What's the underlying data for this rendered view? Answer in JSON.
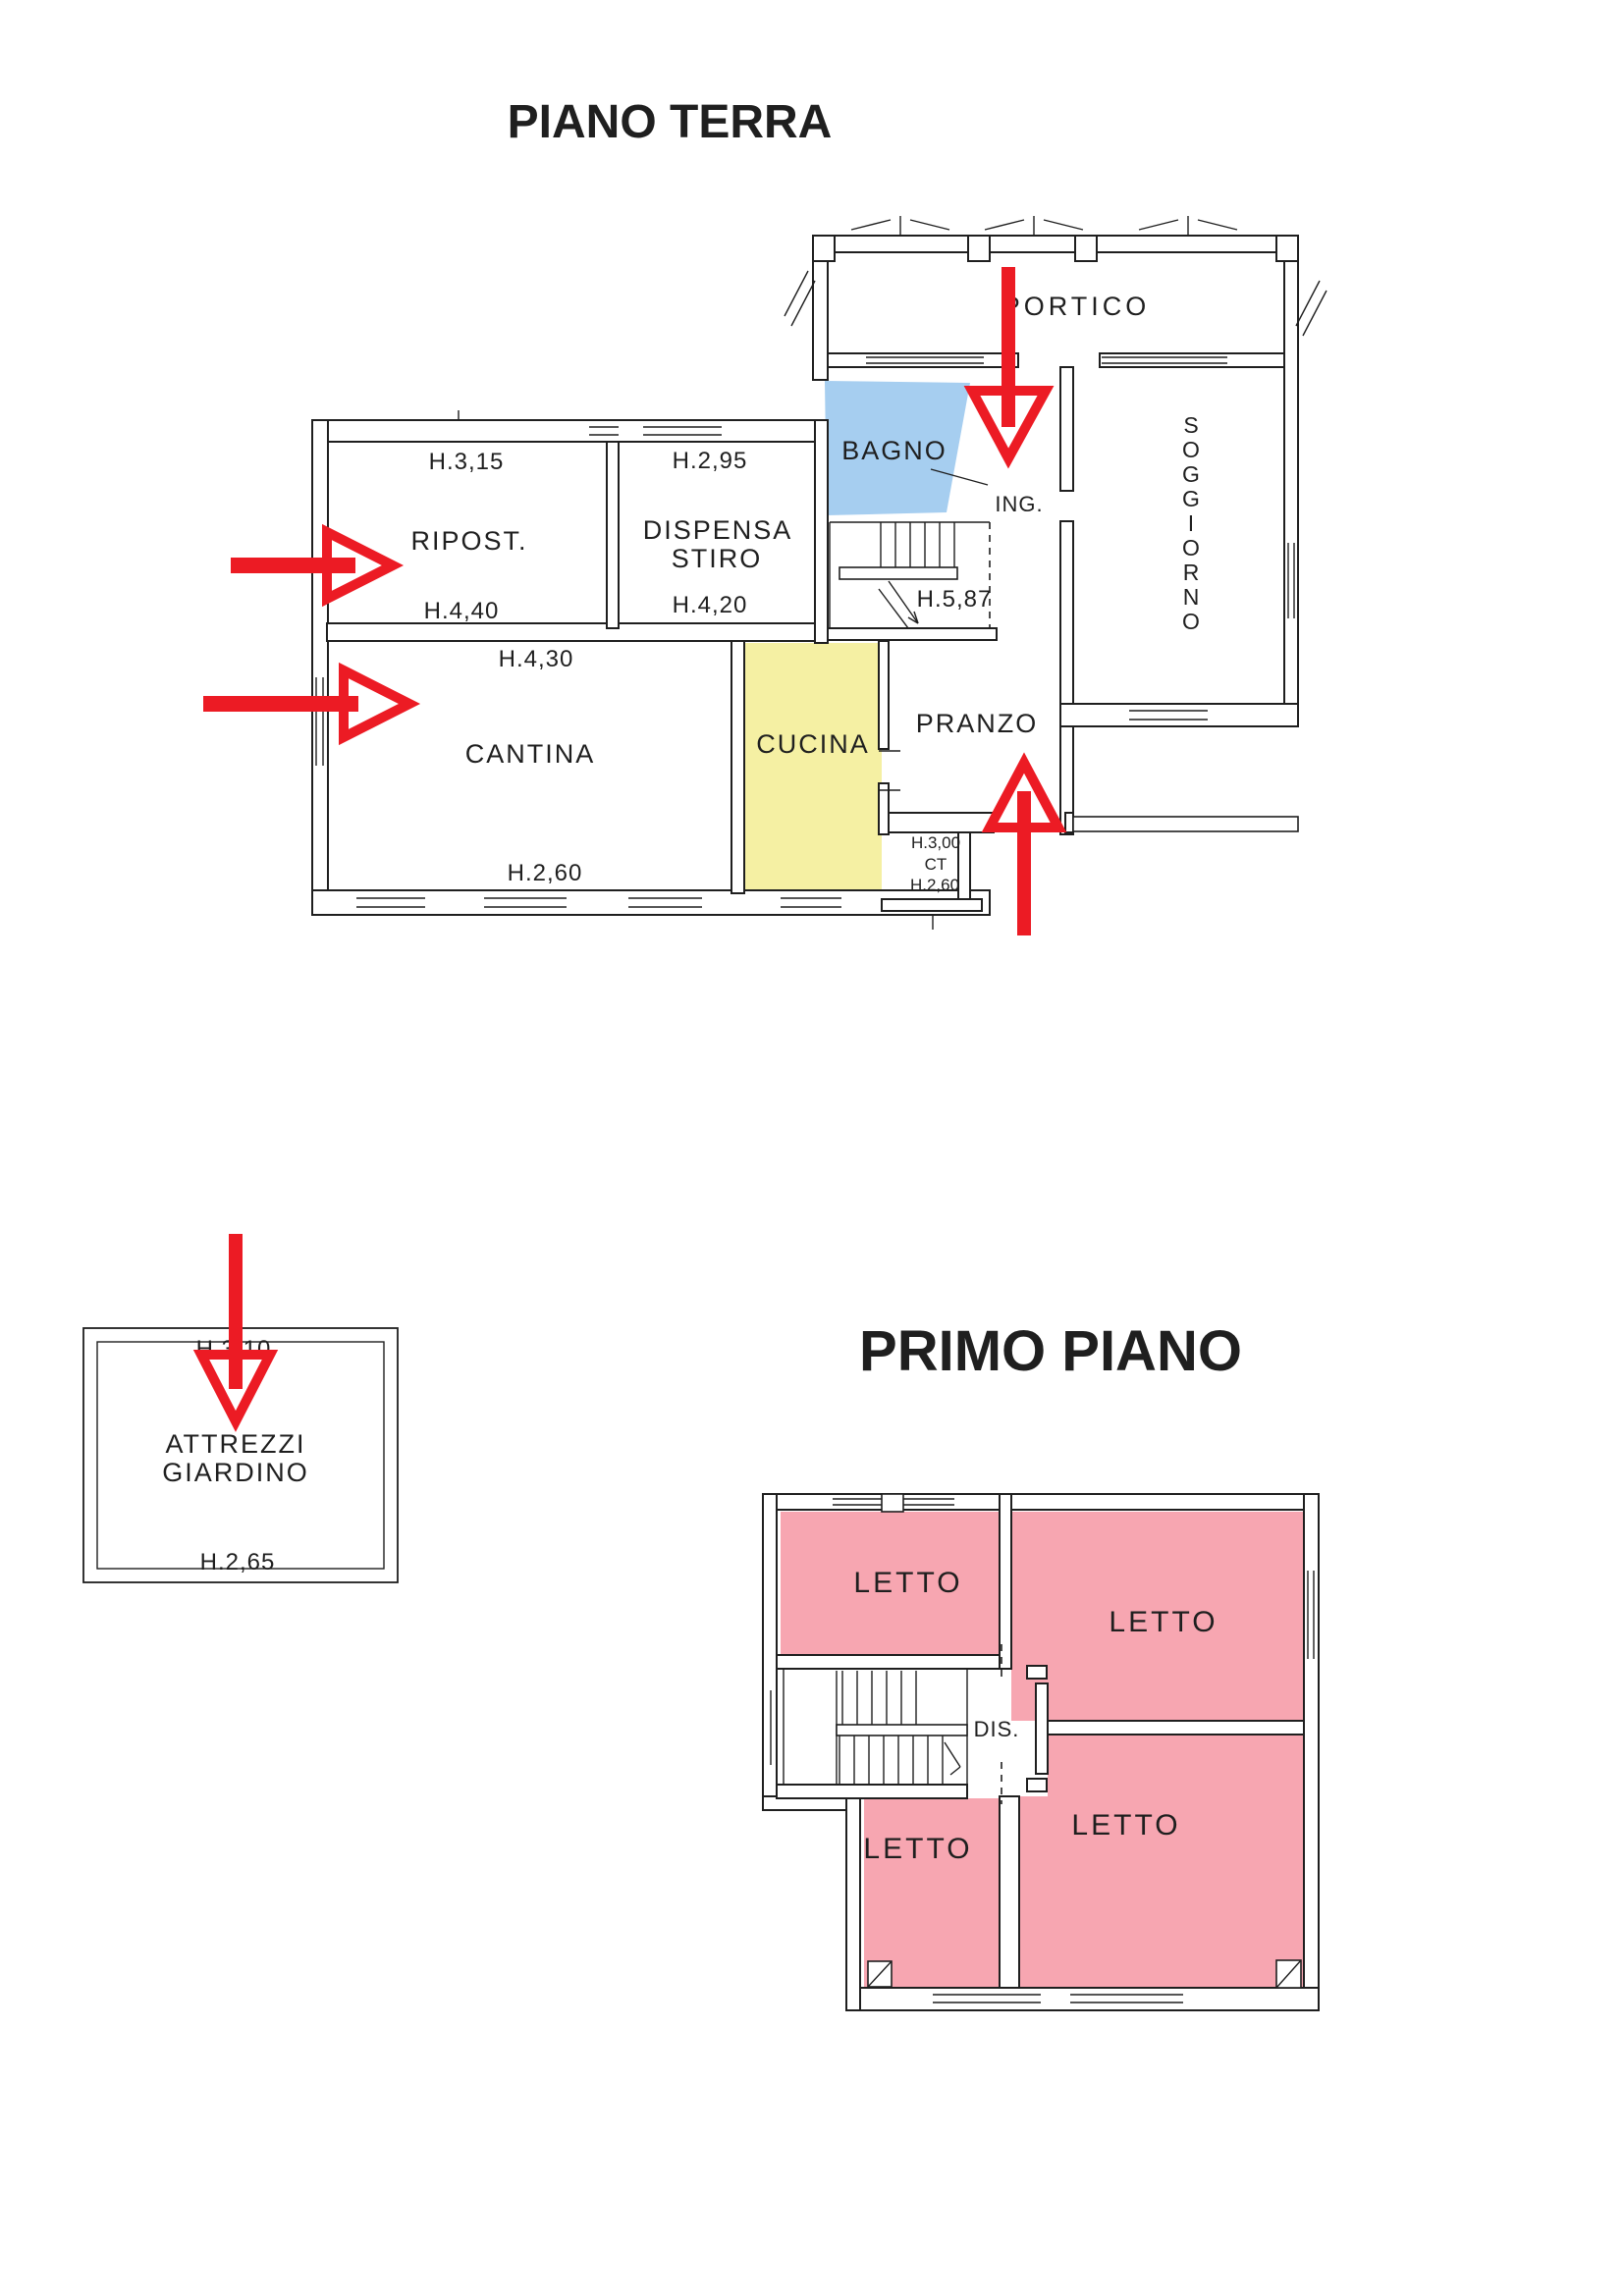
{
  "colors": {
    "arrow": "#EC1B24",
    "title": "#EC1B24",
    "bagno_fill": "#A6CEF0",
    "bagno_text": "#2B6CB8",
    "cucina_fill": "#F5F0A3",
    "cucina_text": "#8F8F45",
    "letto_fill": "#F7A6B1",
    "letto_text": "#7A2B35",
    "line": "#1F1F1F",
    "background": "#FFFFFF"
  },
  "ground": {
    "title": "PIANO TERRA",
    "rooms": {
      "portico": "PORTICO",
      "bagno": "BAGNO",
      "ingresso": "ING.",
      "soggiorno": [
        "S",
        "O",
        "G",
        "G",
        "I",
        "O",
        "R",
        "N",
        "O"
      ],
      "ripostiglio": {
        "height_top": "H.3,15",
        "label": "RIPOST.",
        "height_bottom": "H.4,40"
      },
      "dispensa": {
        "height_top": "H.2,95",
        "label_line1": "DISPENSA",
        "label_line2": "STIRO",
        "height_bottom": "H.4,20"
      },
      "cantina": {
        "height_top": "H.4,30",
        "label": "CANTINA",
        "height_bottom": "H.2,60"
      },
      "cucina": {
        "label": "CUCINA"
      },
      "pranzo": {
        "label": "PRANZO"
      },
      "scala": {
        "height": "H.5,87"
      },
      "ct": {
        "height_top": "H.3,00",
        "label": "CT",
        "height_bottom": "H.2,60"
      }
    }
  },
  "shed": {
    "height_top": "H.3,10",
    "label_line1": "ATTREZZI",
    "label_line2": "GIARDINO",
    "height_bottom": "H.2,65"
  },
  "first": {
    "title": "PRIMO PIANO",
    "rooms": {
      "letto_nw": "LETTO",
      "letto_ne": "LETTO",
      "letto_se": "LETTO",
      "letto_sw": "LETTO",
      "disimpegno": "DIS."
    }
  }
}
